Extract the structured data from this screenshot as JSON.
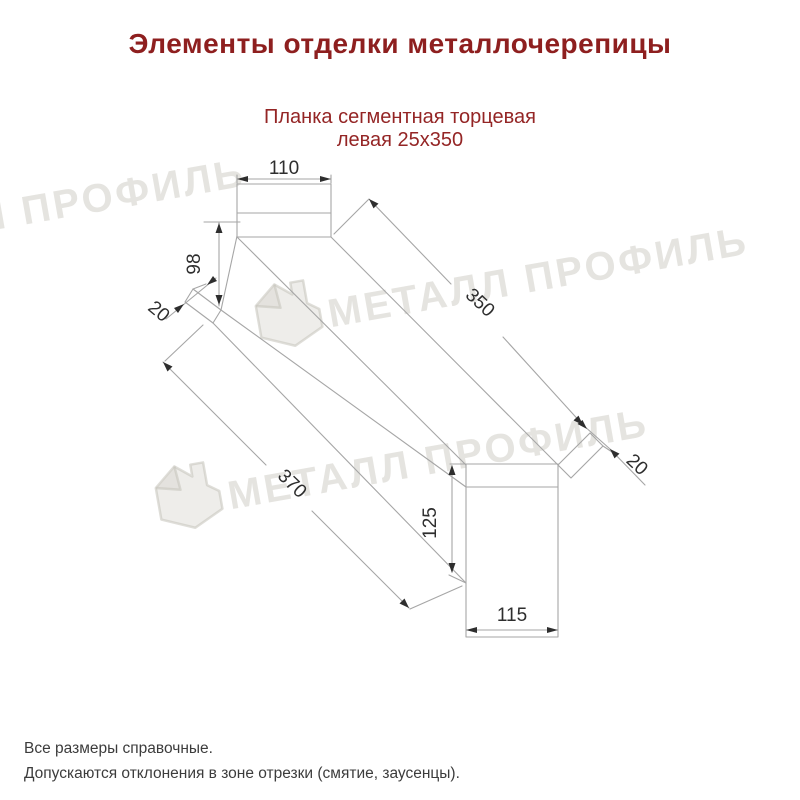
{
  "header": {
    "title": "Элементы отделки металлочерепицы",
    "subtitle_line1": "Планка сегментная торцевая",
    "subtitle_line2": "левая 25х350"
  },
  "drawing": {
    "product": "Планка сегментная торцевая левая 25х350",
    "dimensions": {
      "top_width": "110",
      "left_height": "98",
      "left_hem": "20",
      "top_length": "350",
      "bottom_length": "370",
      "right_hem": "20",
      "right_height": "125",
      "bottom_width": "115"
    }
  },
  "watermark": {
    "text": "МЕТАЛЛ ПРОФИЛЬ"
  },
  "footer": {
    "line1": "Все размеры справочные.",
    "line2": "Допускаются отклонения в зоне отрезки (смятие, заусенцы)."
  },
  "colors": {
    "accent_red": "#8e1f1f",
    "line_gray": "#a6a6a6",
    "dim_text": "#2e2e2e",
    "watermark_gray": "#d0cec6"
  }
}
